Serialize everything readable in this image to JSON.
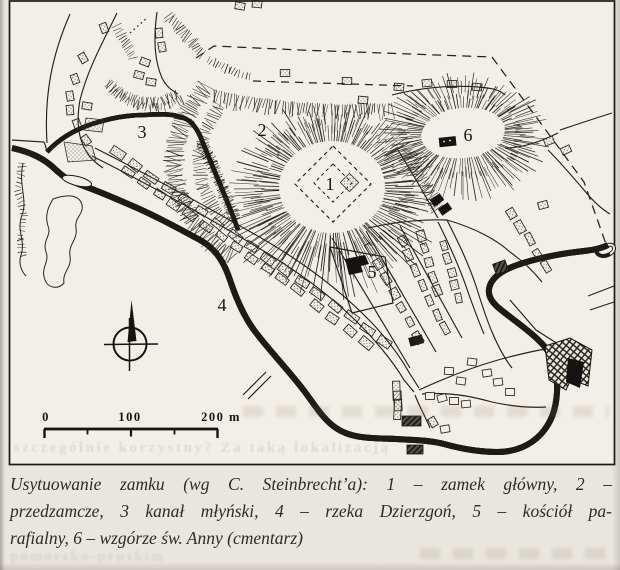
{
  "figure": {
    "map_labels": {
      "main_castle": "1",
      "outer_bailey": "2",
      "mill_canal": "3",
      "river": "4",
      "parish_church": "5",
      "st_anna_hill": "6"
    },
    "scale_bar": {
      "tick0": "0",
      "tick100": "100",
      "tick200": "200 m"
    },
    "caption": {
      "line1": "Usytuowanie zamku (wg C. Steinbrecht’a): 1 – zamek główny, 2 –",
      "line2": "przedzamcze, 3 kanał młyński, 4 – rzeka Dzierzgoń, 5 – kościół pa-",
      "line3": "rafialny, 6 – wzgórze św. Anny (cmentarz)"
    },
    "bleedthrough": {
      "line_mid": "szczególnie korzystny? Za taką lokalizacją",
      "line_bottom": "pomorsko-pruskim"
    }
  }
}
